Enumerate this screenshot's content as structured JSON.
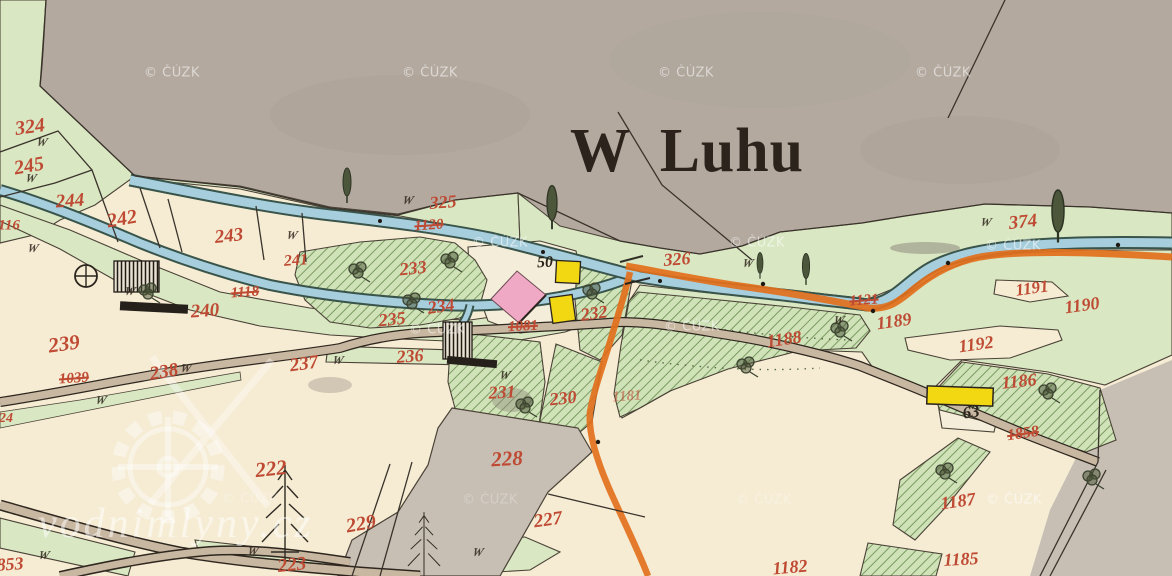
{
  "map": {
    "title": "W Luhu",
    "colors": {
      "paper_cream": "#f6ecd4",
      "area_gray": "#b3a99f",
      "area_gray_dark": "#c7bfb4",
      "meadow_green": "#d9e7c3",
      "hatch_green": "#cfe2b8",
      "hatch_line": "#7d9a63",
      "water_blue": "#a7cedd",
      "water_edge": "#39544a",
      "road_orange": "#e2701c",
      "road_tan": "#c9b8a1",
      "building_pink": "#f0a9c5",
      "building_yellow": "#f2d713",
      "building_black": "#25201a",
      "number_red": "#bf4a33",
      "number_black": "#2b251c",
      "line_black": "#3a332b",
      "watermark_white": "#ffffff"
    },
    "parcel_numbers": [
      {
        "n": "324",
        "x": 30,
        "y": 127,
        "r": -8,
        "s": 20
      },
      {
        "n": "245",
        "x": 29,
        "y": 166,
        "r": -10,
        "s": 20
      },
      {
        "n": "244",
        "x": 70,
        "y": 201,
        "r": -4,
        "s": 19
      },
      {
        "n": "242",
        "x": 122,
        "y": 219,
        "r": -10,
        "s": 20
      },
      {
        "n": "243",
        "x": 229,
        "y": 236,
        "r": -6,
        "s": 19
      },
      {
        "n": "241",
        "x": 296,
        "y": 261,
        "r": -4,
        "s": 16
      },
      {
        "n": "116",
        "x": 9,
        "y": 226,
        "r": 0,
        "s": 15
      },
      {
        "n": "240",
        "x": 205,
        "y": 311,
        "r": -4,
        "s": 19
      },
      {
        "n": "1118",
        "x": 245,
        "y": 293,
        "r": -4,
        "s": 15,
        "st": true
      },
      {
        "n": "239",
        "x": 64,
        "y": 344,
        "r": -8,
        "s": 21
      },
      {
        "n": "1039",
        "x": 74,
        "y": 379,
        "r": -4,
        "s": 15,
        "st": true
      },
      {
        "n": "238",
        "x": 164,
        "y": 372,
        "r": -10,
        "s": 19
      },
      {
        "n": "237",
        "x": 304,
        "y": 364,
        "r": -8,
        "s": 19
      },
      {
        "n": "236",
        "x": 410,
        "y": 356,
        "r": -4,
        "s": 18
      },
      {
        "n": "235",
        "x": 392,
        "y": 319,
        "r": -6,
        "s": 18
      },
      {
        "n": "234",
        "x": 441,
        "y": 306,
        "r": -8,
        "s": 18
      },
      {
        "n": "233",
        "x": 413,
        "y": 268,
        "r": -6,
        "s": 18
      },
      {
        "n": "232",
        "x": 594,
        "y": 313,
        "r": -8,
        "s": 18
      },
      {
        "n": "1081",
        "x": 523,
        "y": 327,
        "r": -3,
        "s": 15,
        "st": true
      },
      {
        "n": "231",
        "x": 502,
        "y": 392,
        "r": -3,
        "s": 18
      },
      {
        "n": "230",
        "x": 563,
        "y": 398,
        "r": -6,
        "s": 18
      },
      {
        "n": "1181",
        "x": 627,
        "y": 397,
        "r": -4,
        "s": 15,
        "o": 0.55
      },
      {
        "n": "228",
        "x": 507,
        "y": 459,
        "r": -3,
        "s": 21
      },
      {
        "n": "222",
        "x": 271,
        "y": 469,
        "r": -6,
        "s": 21
      },
      {
        "n": "229",
        "x": 361,
        "y": 524,
        "r": -10,
        "s": 20
      },
      {
        "n": "227",
        "x": 548,
        "y": 520,
        "r": -8,
        "s": 19
      },
      {
        "n": "223",
        "x": 292,
        "y": 565,
        "r": -6,
        "s": 19
      },
      {
        "n": "853",
        "x": 10,
        "y": 564,
        "r": -4,
        "s": 18
      },
      {
        "n": "1182",
        "x": 790,
        "y": 567,
        "r": -5,
        "s": 18
      },
      {
        "n": "1185",
        "x": 961,
        "y": 559,
        "r": -3,
        "s": 18
      },
      {
        "n": "1187",
        "x": 958,
        "y": 501,
        "r": -8,
        "s": 18
      },
      {
        "n": "1186",
        "x": 1019,
        "y": 381,
        "r": -6,
        "s": 18
      },
      {
        "n": "1858",
        "x": 1023,
        "y": 434,
        "r": -8,
        "s": 16,
        "st": true
      },
      {
        "n": "1188",
        "x": 784,
        "y": 339,
        "r": -8,
        "s": 18
      },
      {
        "n": "1189",
        "x": 894,
        "y": 321,
        "r": -8,
        "s": 18
      },
      {
        "n": "1192",
        "x": 976,
        "y": 344,
        "r": -8,
        "s": 18
      },
      {
        "n": "1190",
        "x": 1082,
        "y": 305,
        "r": -8,
        "s": 18
      },
      {
        "n": "1191",
        "x": 1032,
        "y": 288,
        "r": -8,
        "s": 17
      },
      {
        "n": "1121",
        "x": 864,
        "y": 301,
        "r": -4,
        "s": 15,
        "st": true
      },
      {
        "n": "374",
        "x": 1023,
        "y": 222,
        "r": -6,
        "s": 19
      },
      {
        "n": "326",
        "x": 677,
        "y": 259,
        "r": -4,
        "s": 18
      },
      {
        "n": "325",
        "x": 443,
        "y": 202,
        "r": -4,
        "s": 18
      },
      {
        "n": "1120",
        "x": 429,
        "y": 226,
        "r": -4,
        "s": 15,
        "st": true
      },
      {
        "n": "24",
        "x": 6,
        "y": 419,
        "r": 0,
        "s": 14
      }
    ],
    "house_numbers": [
      {
        "n": "50",
        "x": 545,
        "y": 263,
        "r": -3,
        "s": 16
      },
      {
        "n": "63",
        "x": 971,
        "y": 412,
        "r": -8,
        "s": 17
      }
    ],
    "meadow_mark": "W",
    "meadow_marks": [
      {
        "x": 42,
        "y": 142
      },
      {
        "x": 31,
        "y": 178
      },
      {
        "x": 33,
        "y": 248
      },
      {
        "x": 130,
        "y": 291
      },
      {
        "x": 292,
        "y": 235
      },
      {
        "x": 408,
        "y": 200
      },
      {
        "x": 748,
        "y": 263
      },
      {
        "x": 986,
        "y": 222
      },
      {
        "x": 839,
        "y": 320
      },
      {
        "x": 338,
        "y": 360
      },
      {
        "x": 186,
        "y": 368
      },
      {
        "x": 101,
        "y": 400
      },
      {
        "x": 44,
        "y": 555
      },
      {
        "x": 253,
        "y": 551
      },
      {
        "x": 478,
        "y": 552
      },
      {
        "x": 505,
        "y": 375
      }
    ],
    "watermarks": {
      "cuzk_text": "© ČÚZK",
      "cuzk_positions": [
        {
          "x": 172,
          "y": 73
        },
        {
          "x": 430,
          "y": 73
        },
        {
          "x": 686,
          "y": 73
        },
        {
          "x": 943,
          "y": 73
        },
        {
          "x": 500,
          "y": 243
        },
        {
          "x": 757,
          "y": 243
        },
        {
          "x": 1013,
          "y": 246
        },
        {
          "x": 437,
          "y": 330
        },
        {
          "x": 692,
          "y": 327
        },
        {
          "x": 1014,
          "y": 500
        },
        {
          "x": 764,
          "y": 500,
          "o": 0.3
        },
        {
          "x": 490,
          "y": 500,
          "o": 0.25
        },
        {
          "x": 250,
          "y": 499,
          "o": 0.25
        }
      ],
      "site_text": "vodnimlyny.cz"
    }
  }
}
